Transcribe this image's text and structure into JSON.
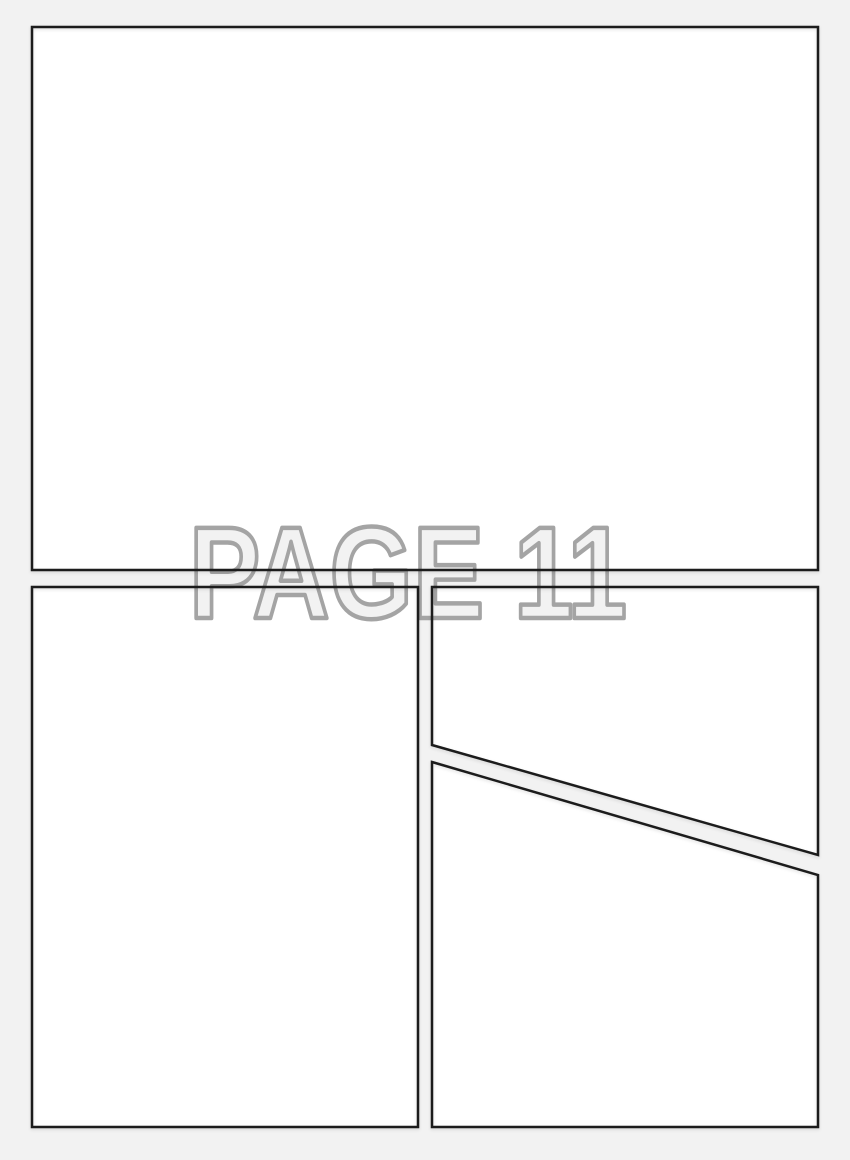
{
  "watermark": {
    "text": "PAGE 11"
  },
  "colors": {
    "page_background": "#f2f2f2",
    "panel_fill": "#ffffff",
    "panel_border": "#1d1d1d",
    "watermark_fill": "#f2f2f2",
    "watermark_outline": "#a4a4a4"
  }
}
